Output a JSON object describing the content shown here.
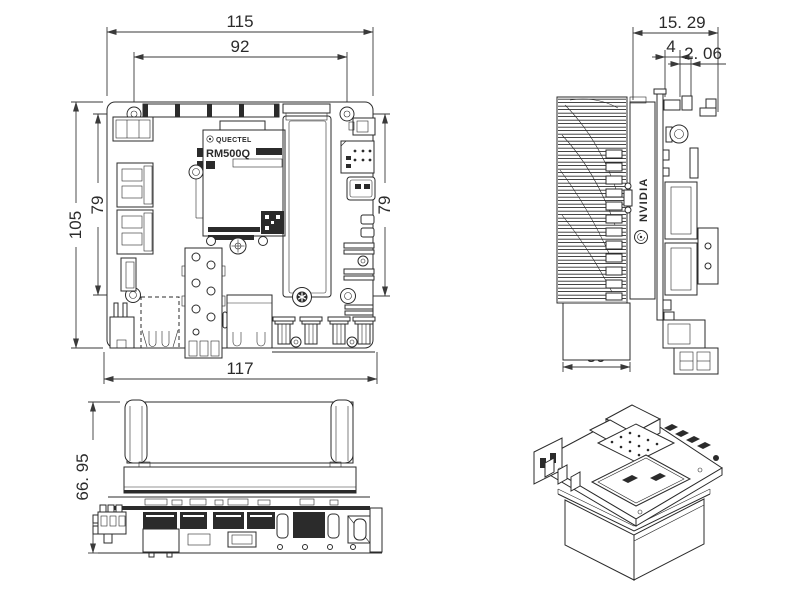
{
  "colors": {
    "background": "#ffffff",
    "line": "#2b2b2b"
  },
  "views": {
    "top": {
      "dims": {
        "width_outer": "115",
        "width_holes": "92",
        "height_outer": "105",
        "height_holes_left": "79",
        "height_holes_right": "79",
        "width_bottom": "117"
      },
      "module": {
        "brand": "QUECTEL",
        "model": "RM500Q"
      }
    },
    "side": {
      "dims": {
        "overhang_total": "15. 29",
        "overhang_mid": "4",
        "overhang_small": "2. 06",
        "heatsink_depth": "30"
      },
      "logo": "NVIDIA"
    },
    "front": {
      "dims": {
        "height_total": "66. 95"
      }
    }
  }
}
